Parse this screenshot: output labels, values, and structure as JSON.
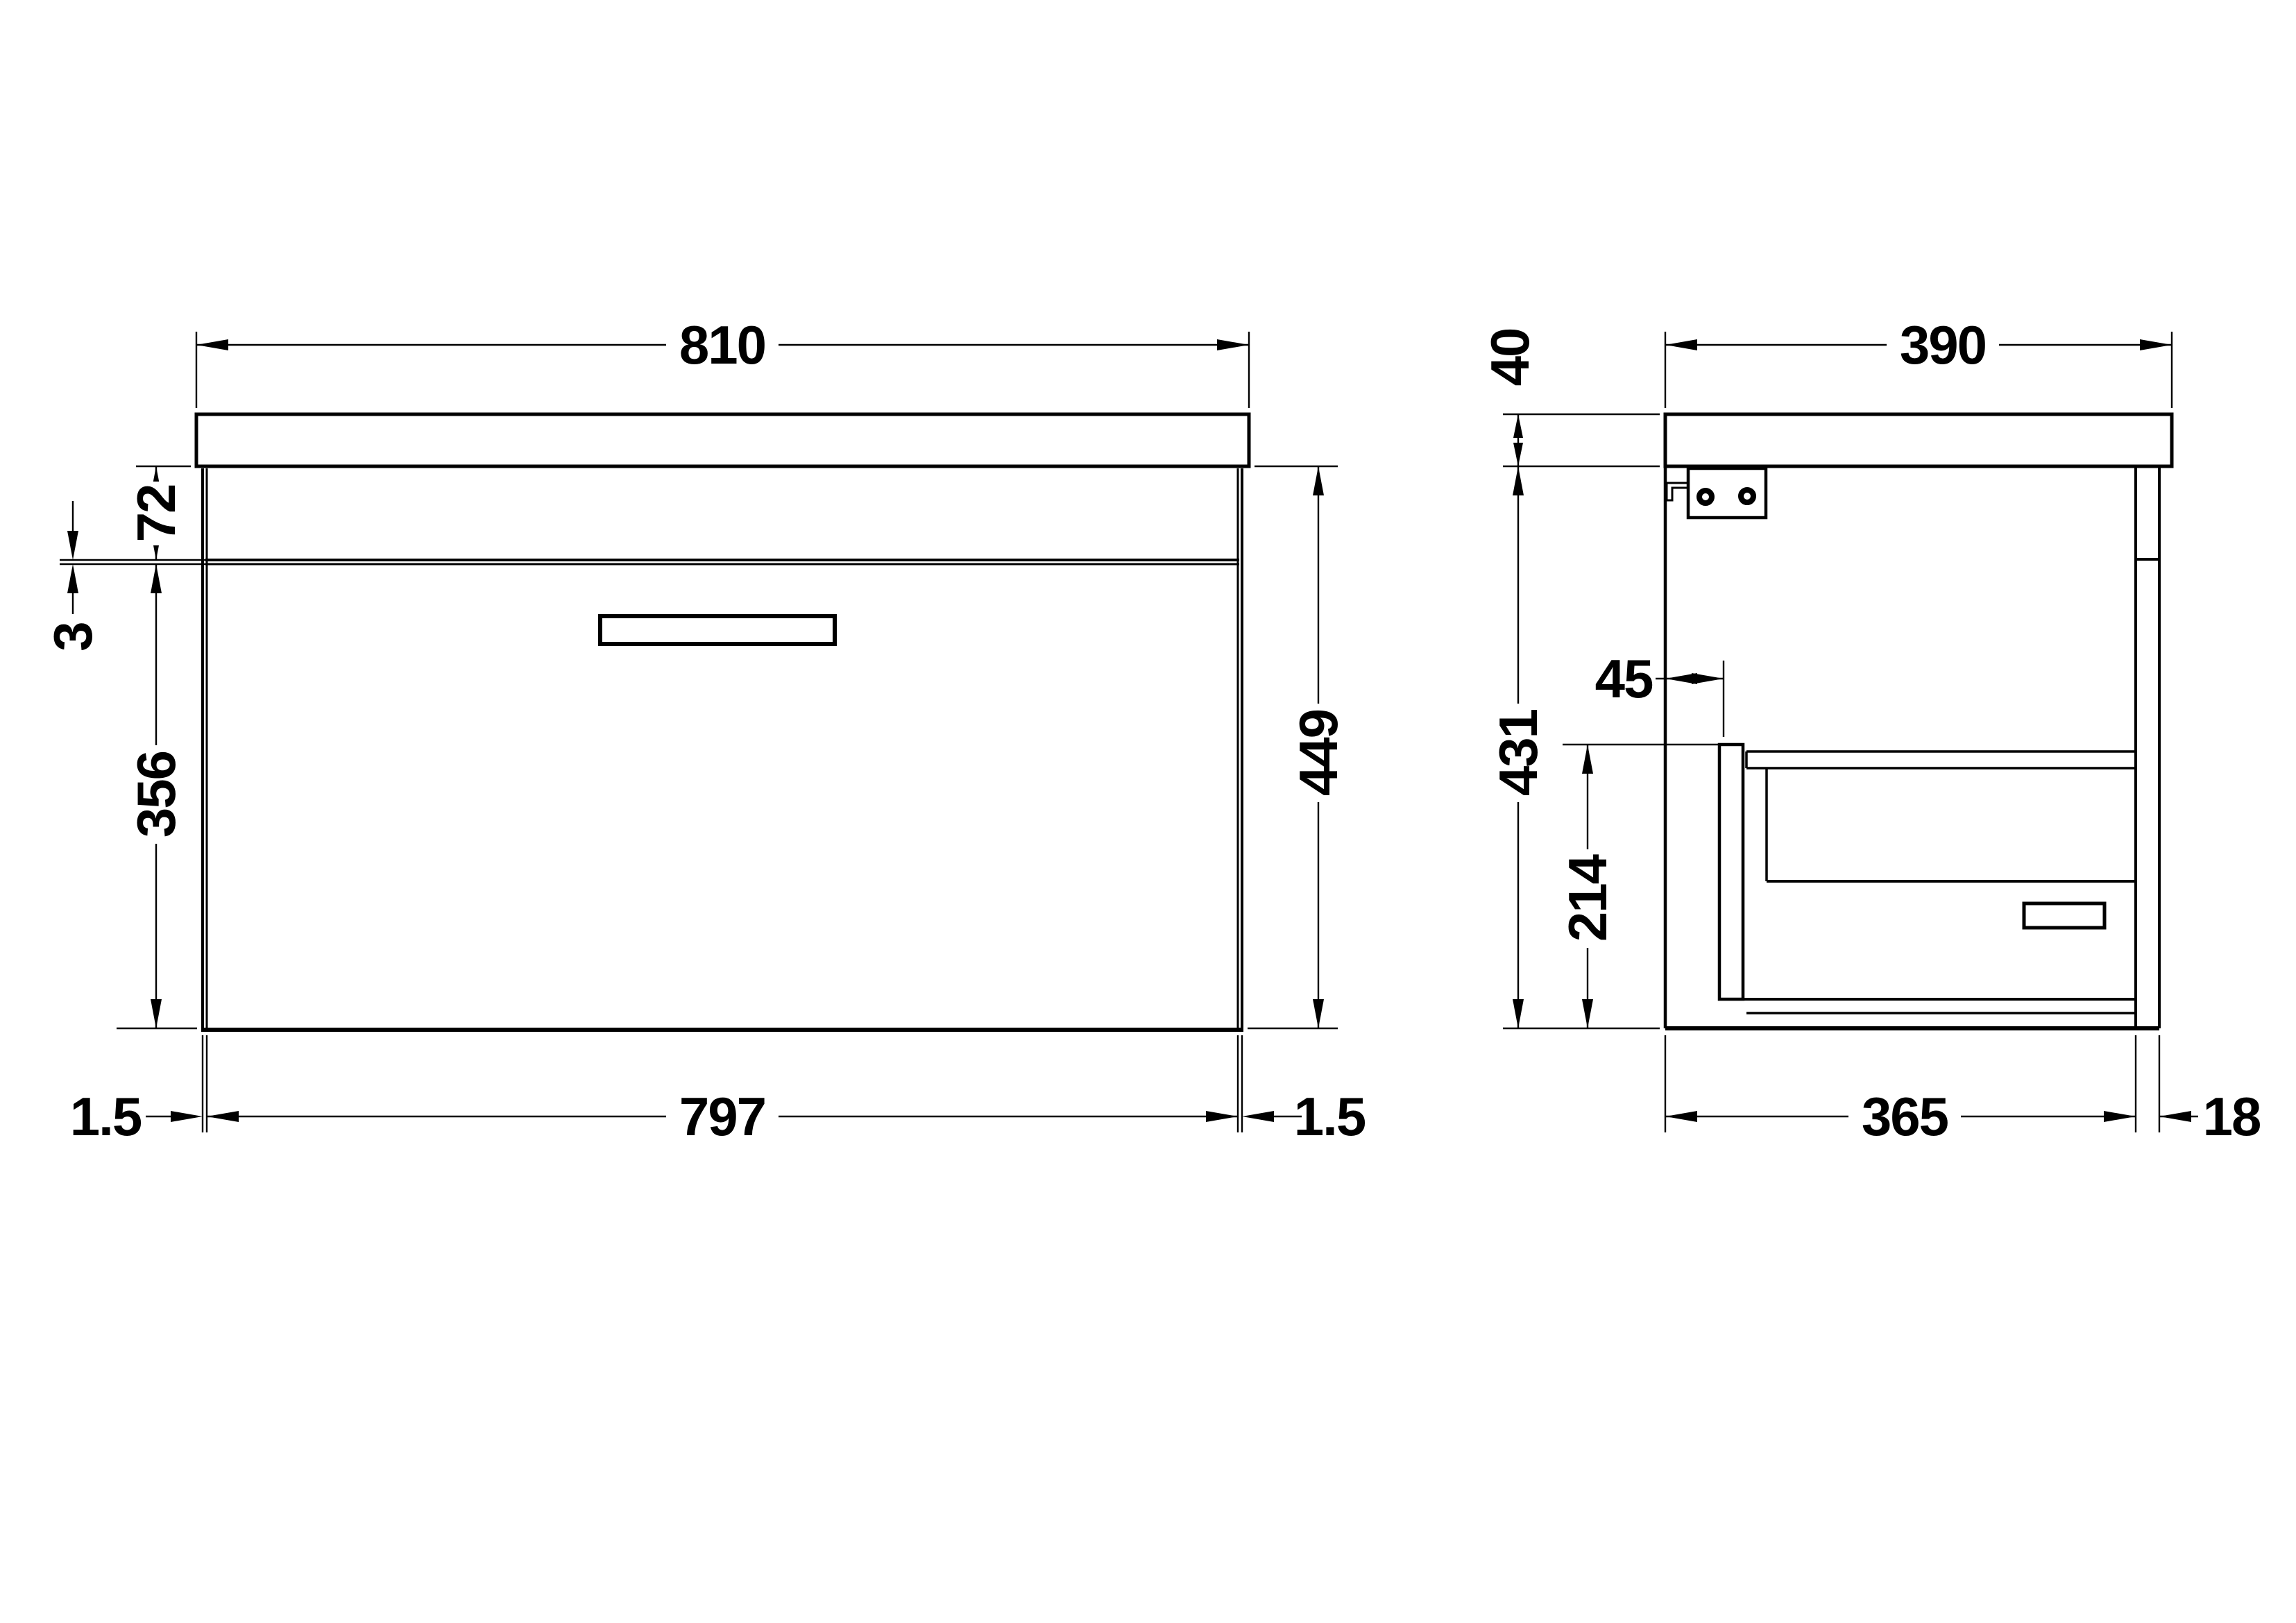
{
  "drawing": {
    "background": "#ffffff",
    "line_color": "#000000",
    "front_view": {
      "worktop_width": "810",
      "apron_height": "72",
      "drawer_gap": "3",
      "drawer_front_height": "356",
      "overall_height": "449",
      "drawer_front_width": "797",
      "side_gap_left": "1.5",
      "side_gap_right": "1.5"
    },
    "side_view": {
      "worktop_depth": "390",
      "worktop_thickness": "40",
      "carcass_height": "431",
      "drawer_box_setback": "45",
      "drawer_box_height": "214",
      "carcass_depth": "365",
      "back_rail_depth": "18"
    }
  }
}
